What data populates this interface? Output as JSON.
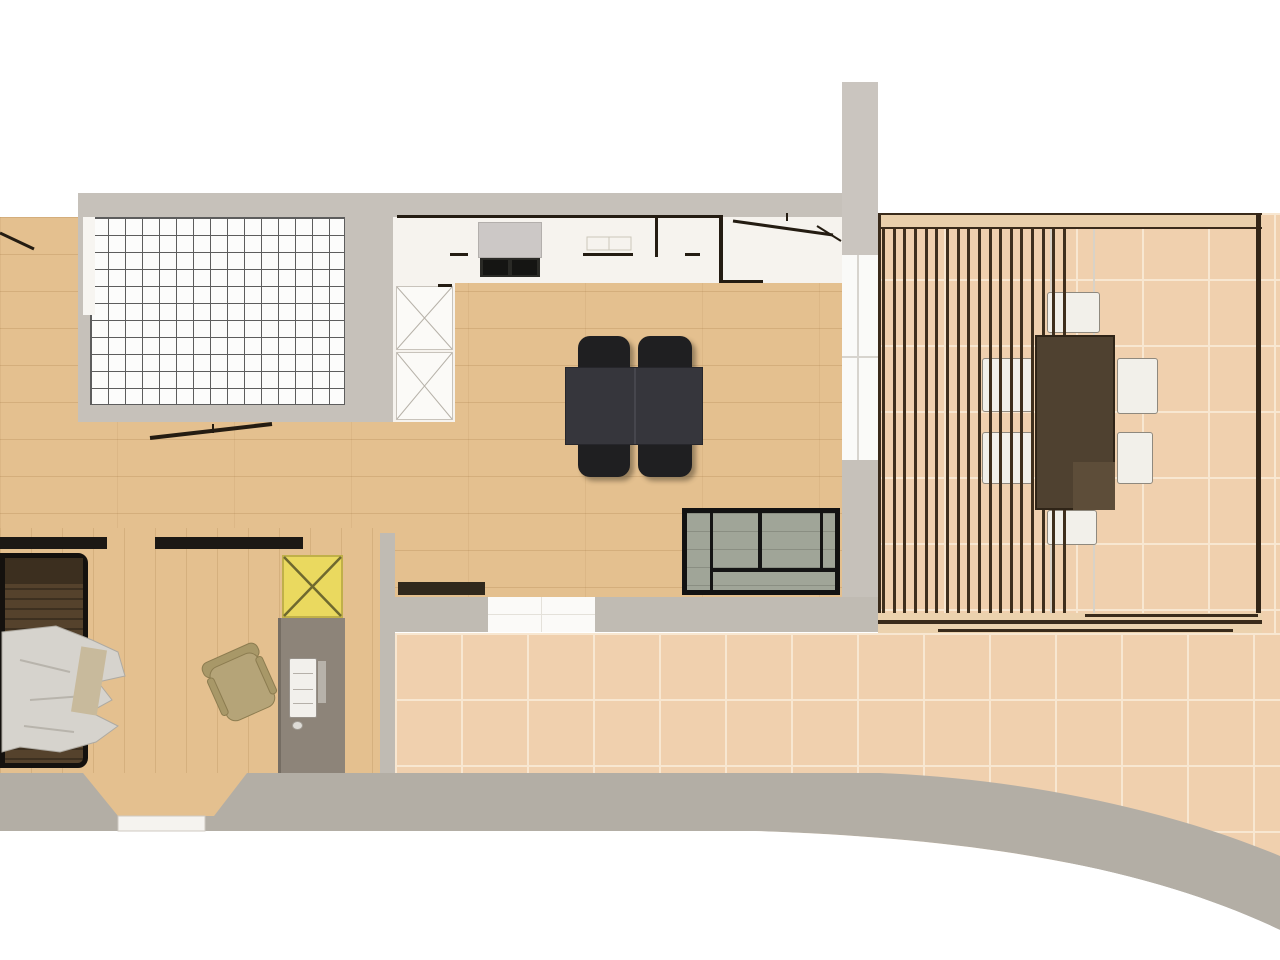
{
  "title": "Apartment floor plan (top-down architectural drawing, no text labels)",
  "colors": {
    "wood": "#e4c08f",
    "wall": "#c6c1ba",
    "bandGray": "#b3aea5",
    "kitchen": "#f6f3ee",
    "gridTile": "#fcfcfb",
    "gridLine": "#5d5d5d",
    "tile": "#f0d0ae",
    "tileLine": "#f8e7d1",
    "ink": "#241c12",
    "pergWood": "#3f2f1d",
    "pergBar": "#e9cfab",
    "diningTable": "#36363c",
    "diningChair": "#1f1f21",
    "sofaCushion": "#a0a598",
    "sofaFrame": "#121212",
    "outdoorTable": "#4f4130",
    "outdoorChair": "#f2f0ea",
    "bedWood": "#55422c",
    "blanket": "#d6d3cd",
    "desk": "#8d8479",
    "shower": "#ead95f",
    "showerLine": "#6f692f",
    "chairTan": "#b5a478",
    "stove": "#ccc8c6",
    "stoveDark": "#2a2a26",
    "glass": "#fafaf8"
  },
  "pergola": {
    "slat_count": 18
  },
  "grid_room": {
    "cols": 15,
    "rows": 11
  },
  "dining": {
    "chair_count": 4
  },
  "outdoor_dining": {
    "chair_count": 6
  }
}
